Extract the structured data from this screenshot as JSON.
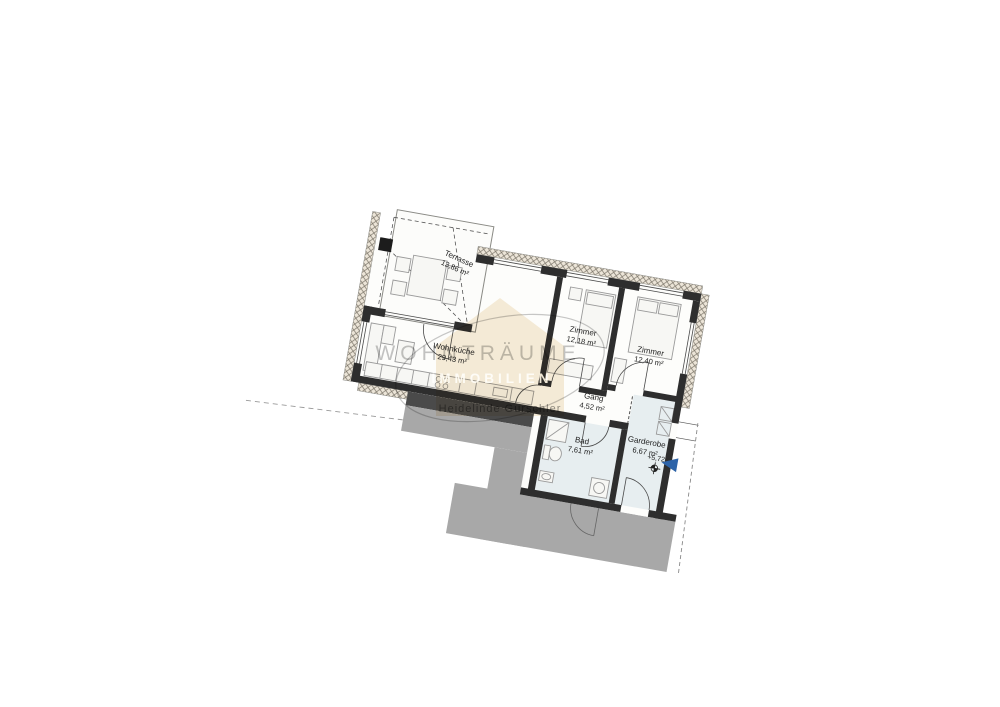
{
  "plan": {
    "rooms": [
      {
        "name": "Wohnküche",
        "area": "29,43 m²"
      },
      {
        "name": "Zimmer",
        "area": "12,18 m²"
      },
      {
        "name": "Zimmer",
        "area": "12,40 m²"
      },
      {
        "name": "Gang",
        "area": "4,52 m²"
      },
      {
        "name": "Bad",
        "area": "7,61 m²"
      },
      {
        "name": "Garderobe",
        "area": "6,67 m²"
      },
      {
        "name": "Terrasse",
        "area": "13,86 m²"
      }
    ],
    "level_marker": "+5,72"
  },
  "watermark": {
    "brand": "WOHNTRÄUME",
    "brand_sub": "IMMOBILIEN",
    "agent_name": "Heidelinde Gurschler"
  },
  "colors": {
    "wall": "#2e2e2e",
    "wet_room_floor": "#e7eef0",
    "stair_gray": "#a8a8a8",
    "shadow_gray": "#4a4a4a",
    "watermark_beige": "#eeddbc",
    "north_arrow_blue": "#2d63a8"
  }
}
